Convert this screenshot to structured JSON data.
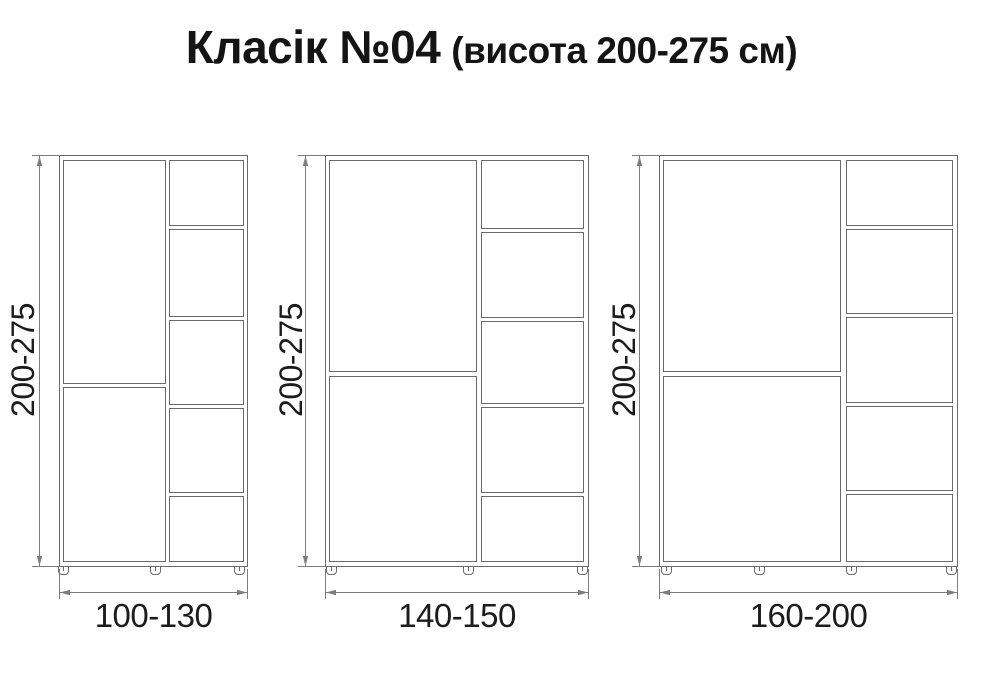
{
  "title": {
    "name": "Класік №04",
    "subtitle": "(висота 200-275 см)"
  },
  "cabinets": [
    {
      "name": "small",
      "height_label": "200-275",
      "width_label": "100-130"
    },
    {
      "name": "medium",
      "height_label": "200-275",
      "width_label": "140-150"
    },
    {
      "name": "large",
      "height_label": "200-275",
      "width_label": "160-200"
    }
  ],
  "colors": {
    "outline": "#6a6a6a",
    "dimension_lines": "#7d7d7d",
    "label_text": "#1c1c1c",
    "title_text": "#141414",
    "background": "#ffffff"
  }
}
